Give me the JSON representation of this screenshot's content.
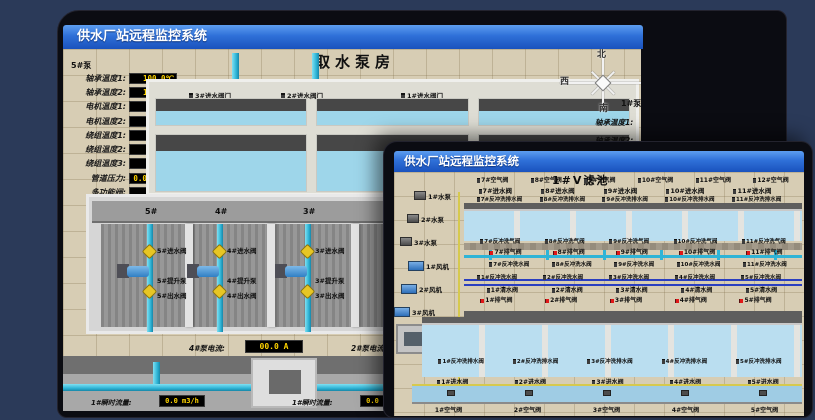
{
  "back_window": {
    "title": "供水厂站远程监控系统",
    "scene_title": "取水泵房",
    "pump_panel": {
      "header": "5#泵",
      "rows": [
        {
          "label": "轴承温度1:",
          "value": "100.0℃"
        },
        {
          "label": "轴承温度2:",
          "value": "100.0℃"
        },
        {
          "label": "电机温度1:",
          "value": "18.1℃"
        },
        {
          "label": "电机温度2:",
          "value": "17.9℃"
        },
        {
          "label": "绕组温度1:",
          "value": "18.0℃"
        },
        {
          "label": "绕组温度2:",
          "value": "18.1℃"
        },
        {
          "label": "绕组温度3:",
          "value": "18.1℃"
        },
        {
          "label": "管道压力:",
          "value": "0.0007MPa"
        },
        {
          "label": "多功能阀:",
          "value": "0%"
        }
      ]
    },
    "intake_valves": [
      "3#进水阀门",
      "2#进水阀门",
      "1#进水阀门"
    ],
    "bay_numbers": [
      "5#",
      "4#",
      "3#",
      "2#"
    ],
    "bays": [
      {
        "inlet": "5#进水阀",
        "pump": "5#提升泵",
        "outlet": "5#出水阀"
      },
      {
        "inlet": "4#进水阀",
        "pump": "4#提升泵",
        "outlet": "4#出水阀"
      },
      {
        "inlet": "3#进水阀",
        "pump": "3#提升泵",
        "outlet": "3#出水阀"
      }
    ],
    "current_left": {
      "label": "4#泵电流:",
      "value": "00.0 A"
    },
    "current_right_label": "2#泵电流:",
    "flow_left": {
      "label": "1#瞬时流量:",
      "value": "0.0 m3/h"
    },
    "flow_right": {
      "label": "1#瞬时流量:",
      "value": "0.0 m3/h"
    },
    "compass": {
      "north": "北",
      "west": "西",
      "south": "南"
    },
    "right_panel": {
      "header": "1#泵",
      "labels": [
        "轴承温度1:",
        "轴承温度2:"
      ]
    }
  },
  "front_window": {
    "title": "供水厂站远程监控系统",
    "scene_title": "1#V滤池",
    "pumps": [
      "1#水泵",
      "2#水泵",
      "3#水泵"
    ],
    "blowers": [
      "1#风机",
      "2#风机",
      "3#风机"
    ],
    "top_air_valves": [
      "7#空气阀",
      "8#空气阀",
      "9#空气阀",
      "10#空气阀",
      "11#空气阀",
      "12#空气阀"
    ],
    "top_inlet_valves": [
      "7#进水阀",
      "8#进水阀",
      "9#进水阀",
      "10#进水阀",
      "11#进水阀"
    ],
    "top_drain_valves": [
      "7#反冲洗排水阀",
      "8#反冲洗排水阀",
      "9#反冲洗排水阀",
      "10#反冲洗排水阀",
      "11#反冲洗排水阀"
    ],
    "gallery": {
      "backwash_air_top": [
        "7#反冲洗气阀",
        "8#反冲洗气阀",
        "9#反冲洗气阀",
        "10#反冲洗气阀",
        "11#反冲洗气阀"
      ],
      "exhaust_top": [
        "7#排气阀",
        "8#排气阀",
        "9#排气阀",
        "10#排气阀",
        "11#排气阀"
      ],
      "backwash_water_top": [
        "7#反冲洗水阀",
        "8#反冲洗水阀",
        "9#反冲洗水阀",
        "10#反冲洗水阀",
        "11#反冲洗水阀"
      ],
      "backwash_water_bottom": [
        "1#反冲洗水阀",
        "2#反冲洗水阀",
        "3#反冲洗水阀",
        "4#反冲洗水阀",
        "5#反冲洗水阀"
      ],
      "clean_water": [
        "1#清水阀",
        "2#清水阀",
        "3#清水阀",
        "4#清水阀",
        "5#清水阀"
      ],
      "exhaust_bottom": [
        "1#排气阀",
        "2#排气阀",
        "3#排气阀",
        "4#排气阀",
        "5#排气阀"
      ]
    },
    "bottom_drain_valves": [
      "1#反冲洗排水阀",
      "2#反冲洗排水阀",
      "3#反冲洗排水阀",
      "4#反冲洗排水阀",
      "5#反冲洗排水阀"
    ],
    "bottom_inlet_valves": [
      "1#进水阀",
      "2#进水阀",
      "3#进水阀",
      "4#进水阀",
      "5#进水阀"
    ],
    "bottom_air_valves": [
      "1#空气阀",
      "2#空气阀",
      "3#空气阀",
      "4#空气阀",
      "5#空气阀"
    ]
  },
  "colors": {
    "titlebar_blue": "#2f70d8",
    "led_yellow": "#ffd400",
    "pipe_cyan": "#2fb4d6",
    "alarm_red": "#e01818",
    "scene_beige": "#d7cdb4"
  }
}
